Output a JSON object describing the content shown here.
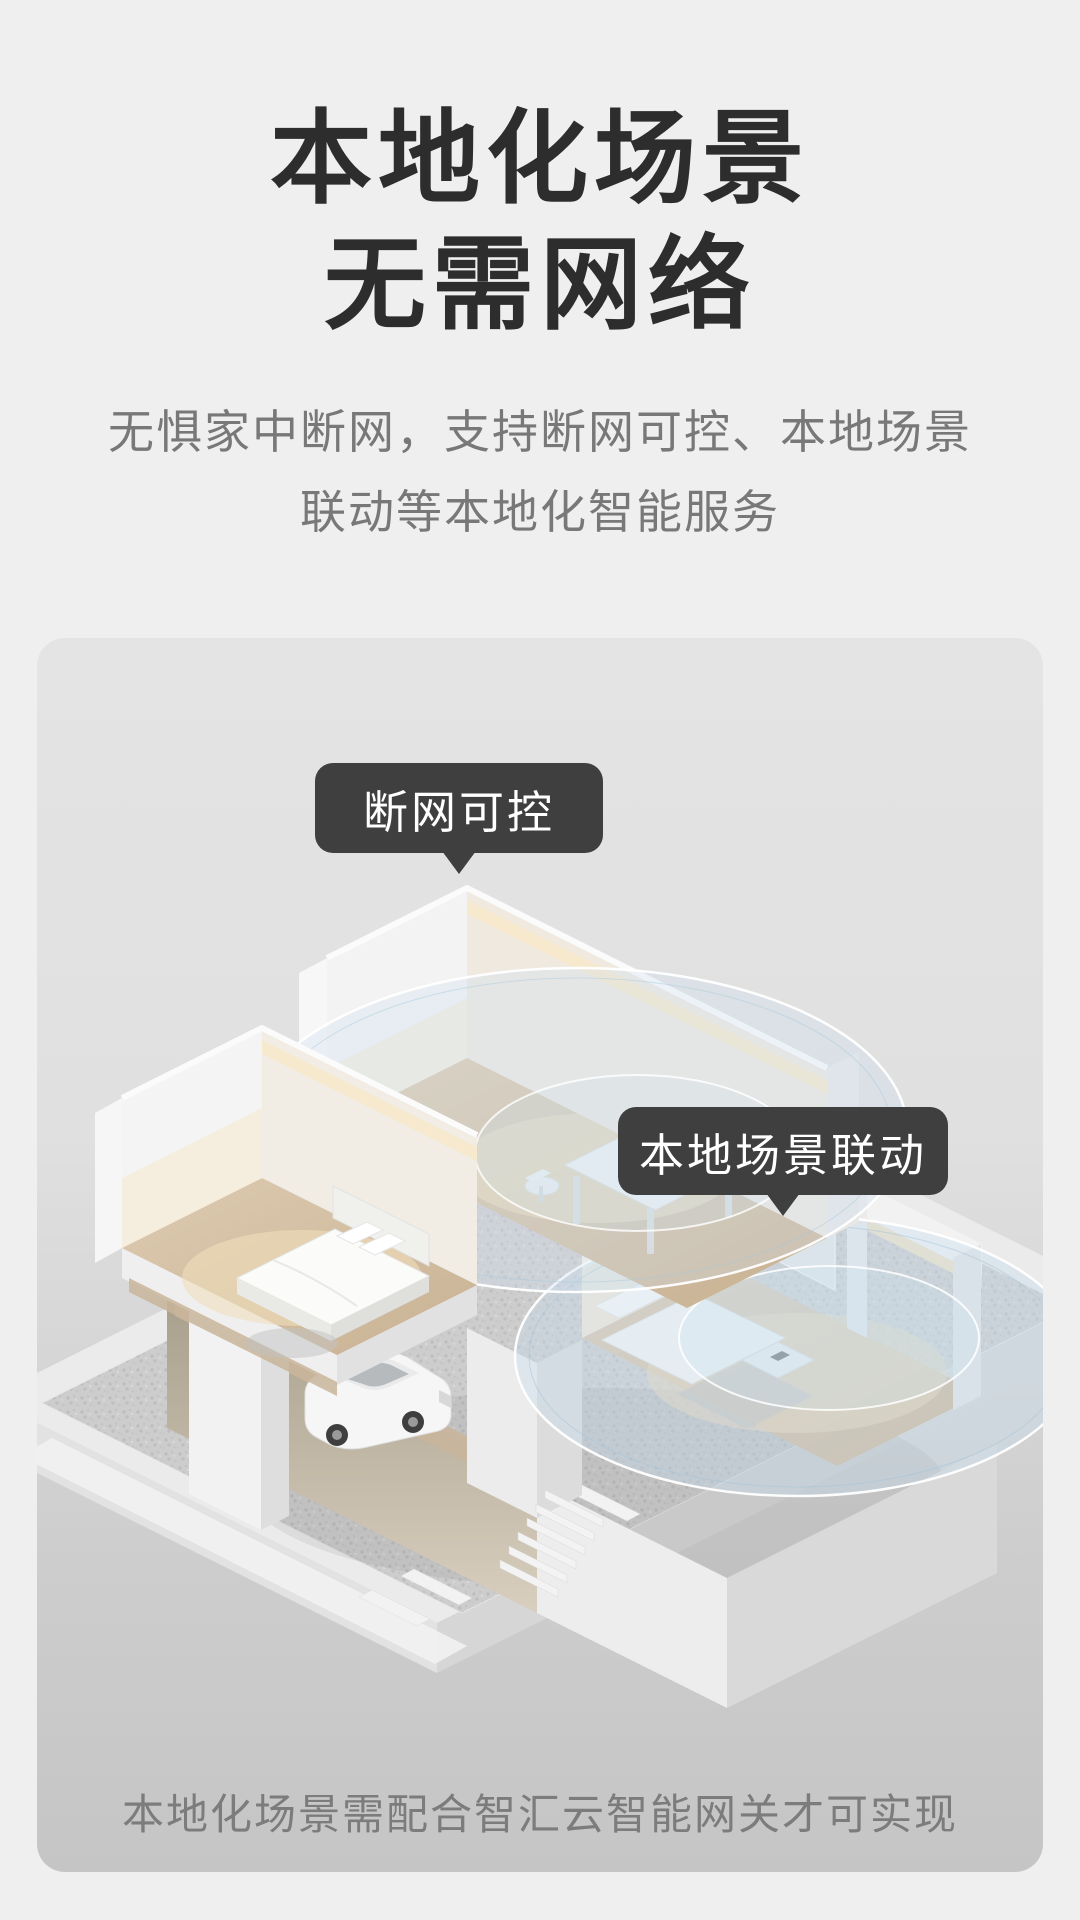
{
  "header": {
    "title_lines": [
      "本地化场景",
      "无需网络"
    ],
    "subtitle_lines": [
      "无惧家中断网，支持断网可控、本地场景",
      "联动等本地化智能服务"
    ]
  },
  "illustration": {
    "callouts": [
      {
        "label": "断网可控"
      },
      {
        "label": "本地场景联动"
      }
    ],
    "caption": "本地化场景需配合智汇云智能网关才可实现",
    "colors": {
      "page_bg": "#efefef",
      "panel_top": "#e4e4e4",
      "panel_bottom": "#c5c5c5",
      "callout_bg": "#3f3f3f",
      "callout_text": "#ffffff",
      "signal_ring": "#bdd7e9",
      "warm_light": "#f6e8cc",
      "wood_floor": "#d8c5a9"
    }
  }
}
